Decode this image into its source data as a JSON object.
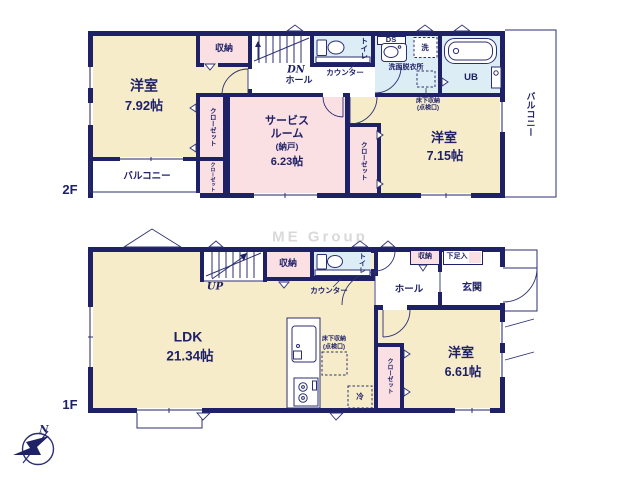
{
  "watermark": "ME Group",
  "colors": {
    "wall_navy": "#1f2166",
    "room_cream": "#f7ecca",
    "room_pink": "#fadfe3",
    "bath_blue": "#dcedf6",
    "watermark_gray": "#d9d9d9"
  },
  "floor2": {
    "label": "2F",
    "room792": {
      "name": "洋室",
      "size": "7.92帖"
    },
    "storage": "収納",
    "stairs_down": "DN",
    "hall": "ホール",
    "toilet": "トイレ",
    "counter": "カウンター",
    "duct": "DS",
    "washer": "洗",
    "washroom": "洗面脱衣所",
    "underfloor_line1": "床下収納",
    "underfloor_line2": "(点検口)",
    "unit_bath": "UB",
    "balcony_side": "バルコニー",
    "balcony_front": "バルコニー",
    "closet_a": "クローゼット",
    "closet_b": "クローゼット",
    "closet_c": "クローゼット",
    "service_room": {
      "line1": "サービス",
      "line2": "ルーム",
      "line3": "(納戸)",
      "size": "6.23帖"
    },
    "room715": {
      "name": "洋室",
      "size": "7.15帖"
    }
  },
  "floor1": {
    "label": "1F",
    "ldk": {
      "name": "LDK",
      "size": "21.34帖"
    },
    "stairs_up": "UP",
    "storage_stairs": "収納",
    "toilet": "トイレ",
    "counter": "カウンター",
    "hall": "ホール",
    "storage_hall": "収納",
    "shoe_box": "下足入",
    "entrance": "玄関",
    "room661": {
      "name": "洋室",
      "size": "6.61帖"
    },
    "closet": "クローゼット",
    "fridge": "冷",
    "underfloor_line1": "床下収納",
    "underfloor_line2": "(点検口)",
    "compass_north": "N"
  }
}
